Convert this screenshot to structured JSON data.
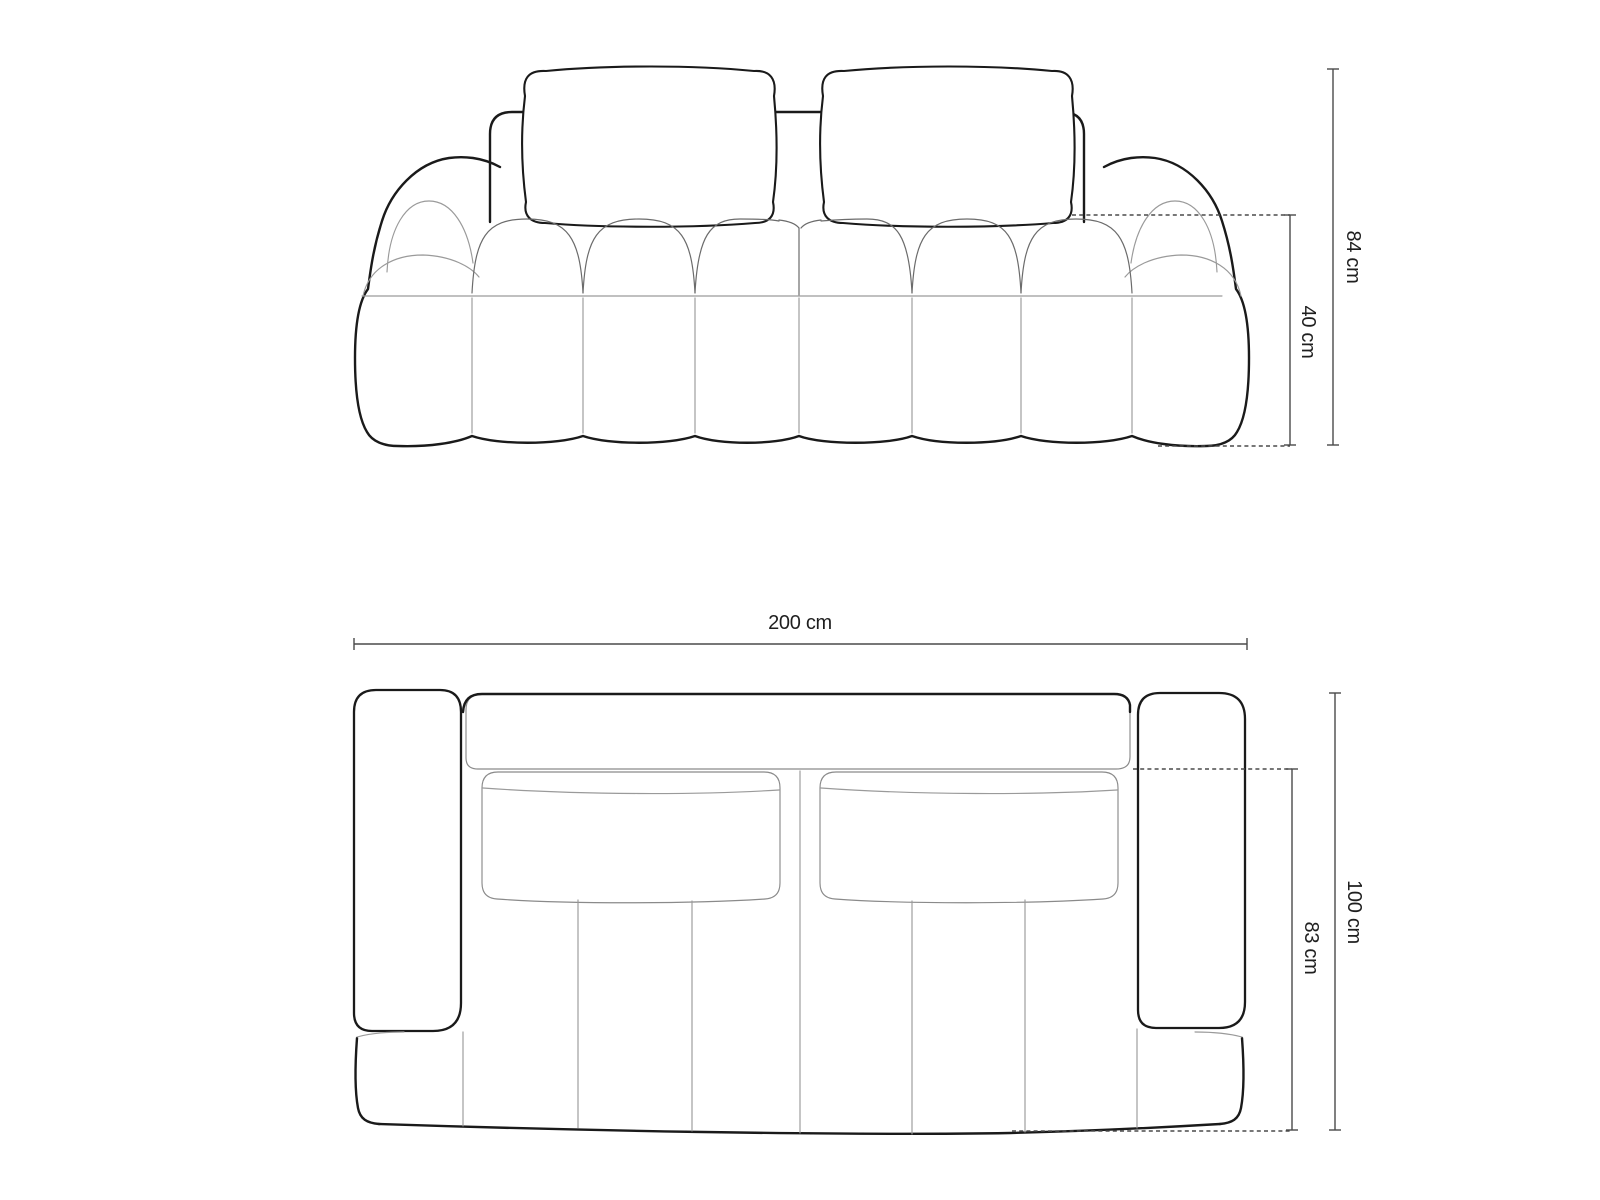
{
  "front_view": {
    "height_label": "84 cm",
    "seat_height_label": "40 cm"
  },
  "top_view": {
    "width_label": "200 cm",
    "depth_label": "100 cm",
    "seat_depth_label": "83 cm"
  },
  "colors": {
    "background": "#ffffff",
    "outline": "#1a1a1a",
    "seam_light": "#9a9a9a",
    "seam_dark": "#6b6b6b",
    "dimension": "#4a4a4a",
    "label": "#1f1f1f"
  }
}
